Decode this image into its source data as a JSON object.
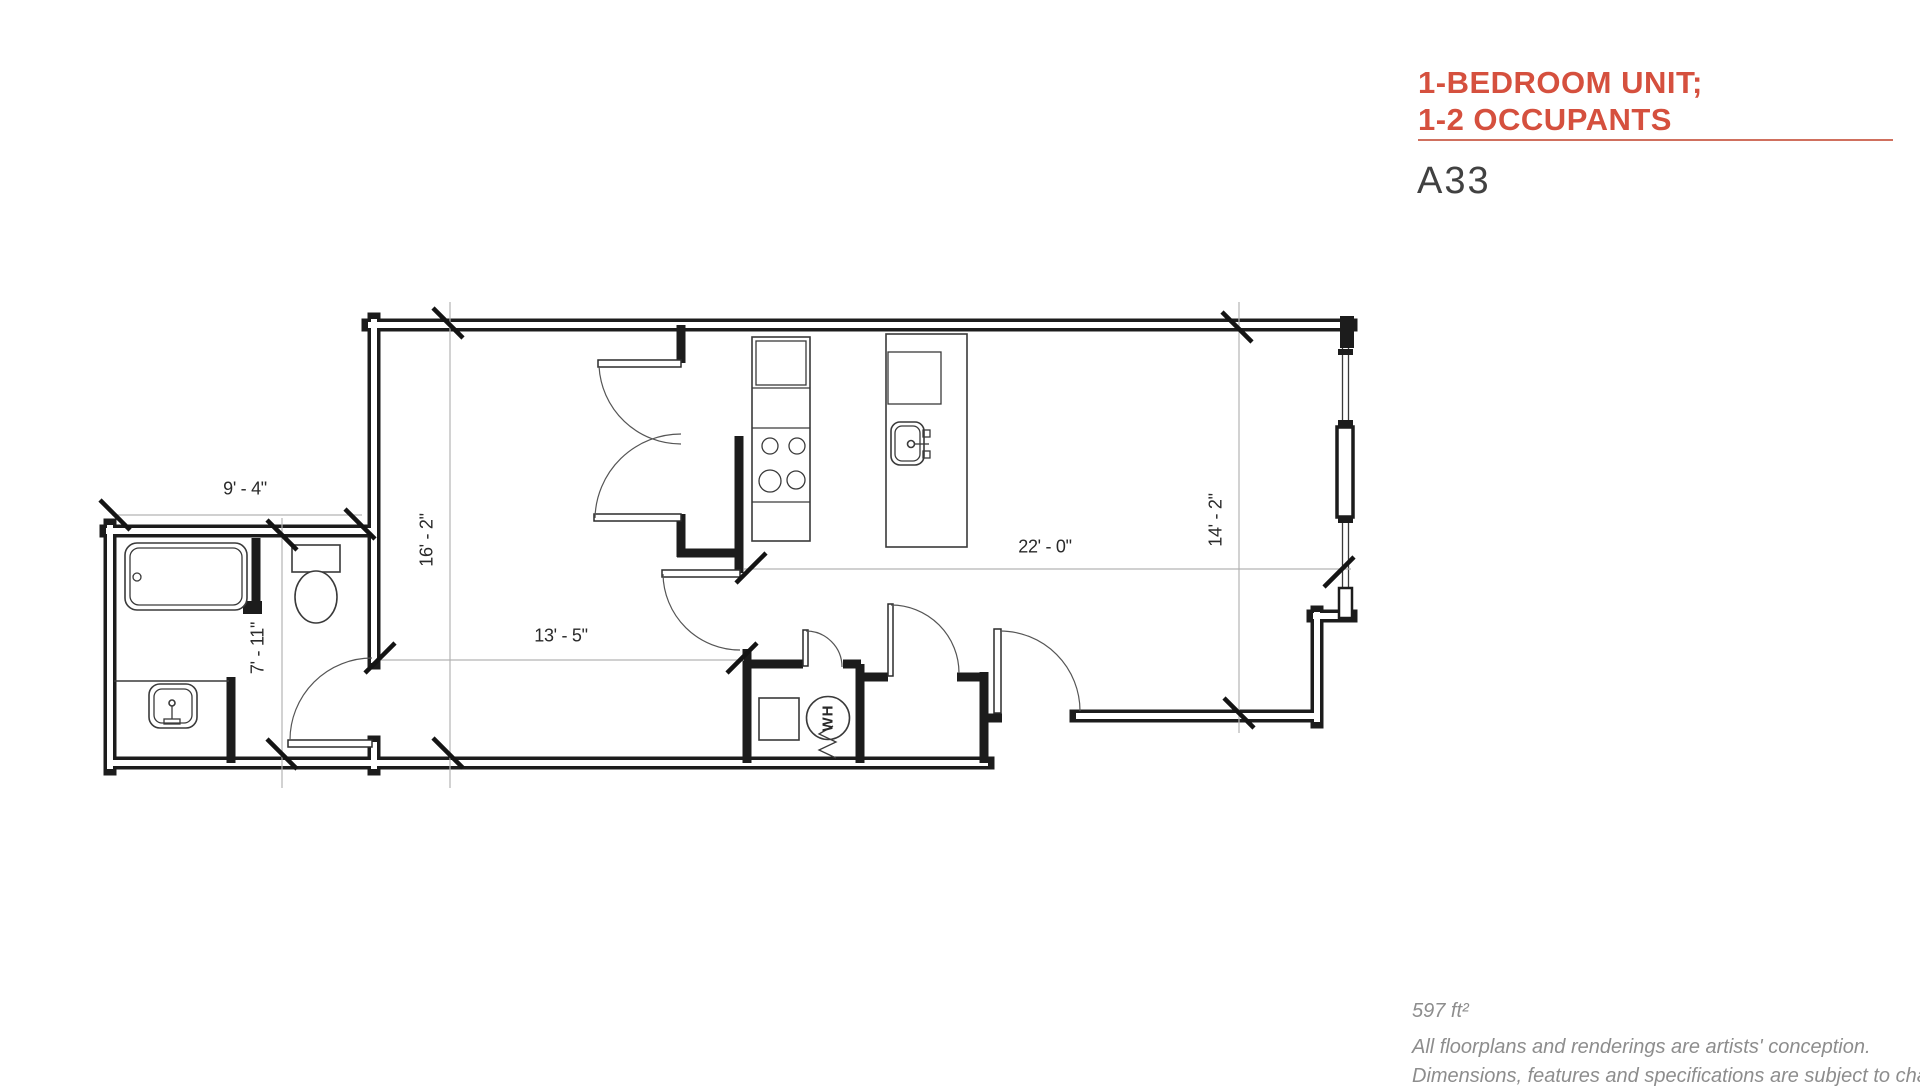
{
  "header": {
    "title_line1": "1-BEDROOM UNIT;",
    "title_line2": "1-2 OCCUPANTS",
    "unit_label": "A33"
  },
  "floorplan": {
    "dim_bath_width": "9' - 4\"",
    "dim_bedroom_depth": "16' - 2\"",
    "dim_bath_depth": "7' - 11\"",
    "dim_bedroom_width": "13' - 5\"",
    "dim_living_width": "22' - 0\"",
    "dim_living_depth": "14' - 2\"",
    "water_heater_label": "WH"
  },
  "footer": {
    "area": "597 ft²",
    "disclaimer_line1": "All floorplans and renderings are artists' conception.",
    "disclaimer_line2": "Dimensions, features and specifications are subject to change."
  },
  "colors": {
    "accent": "#d5503e",
    "underline": "#d0705e",
    "wall": "#1c1c1c"
  }
}
